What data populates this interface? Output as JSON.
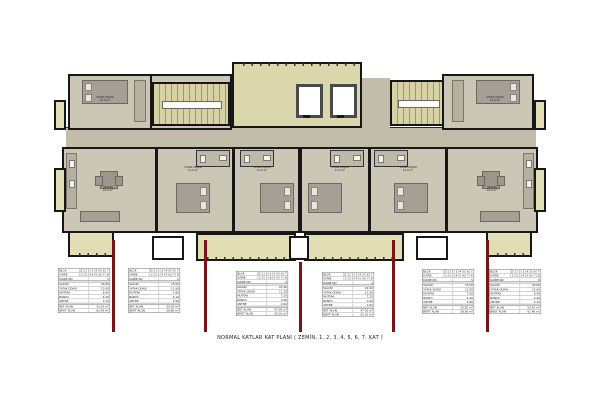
{
  "caption": "NORMAL KATLAR KAT PLANI ( ZEMİN, 1, 2, 3, 4, 5, 6, 7. KAT )",
  "colors": {
    "wall": "#171717",
    "floor": "#ccc6b7",
    "corridor": "#c2bcab",
    "terrace": "#dbd7ac",
    "balcony": "#e1ddb4",
    "stair": "#d6d2a6",
    "section_line": "#7a1517",
    "furniture": "#a5a095",
    "paper": "#ffffff"
  },
  "room_labels": [
    {
      "name": "YATAK ODASI",
      "area": "12.6 m²"
    },
    {
      "name": "SALON",
      "area": "24.8 m²"
    },
    {
      "name": "YATAK ODASI",
      "area": "11.9 m²"
    },
    {
      "name": "YATAK ODASI",
      "area": "11.2 m²"
    },
    {
      "name": "YATAK ODASI",
      "area": "11.2 m²"
    },
    {
      "name": "YATAK ODASI",
      "area": "11.9 m²"
    },
    {
      "name": "YATAK ODASI",
      "area": "12.6 m²"
    },
    {
      "name": "SALON",
      "area": "24.8 m²"
    }
  ],
  "tables": [
    {
      "block_label": "BLOK",
      "floors": [
        "Z",
        "1",
        "2",
        "3",
        "4",
        "5",
        "6",
        "7"
      ],
      "daire_label": "DAİRE",
      "daire_cells": [
        "1",
        "2",
        "3",
        "4",
        "5",
        "6",
        "7",
        "8"
      ],
      "daire_no_label": "DAİRE NO",
      "daire_no": "1",
      "rows": [
        {
          "label": "SALON",
          "value": "24.80"
        },
        {
          "label": "YATAK ODASI",
          "value": "12.60"
        },
        {
          "label": "MUTFAK",
          "value": "8.40"
        },
        {
          "label": "BANYO",
          "value": "4.20"
        },
        {
          "label": "ANTRE",
          "value": "3.10"
        }
      ],
      "totals": [
        {
          "label": "NET ALAN",
          "value": "53.10 m²"
        },
        {
          "label": "BRÜT ALAN",
          "value": "61.40 m²"
        }
      ]
    },
    {
      "block_label": "BLOK",
      "floors": [
        "Z",
        "1",
        "2",
        "3",
        "4",
        "5",
        "6",
        "7"
      ],
      "daire_label": "DAİRE",
      "daire_cells": [
        "1",
        "2",
        "3",
        "4",
        "5",
        "6",
        "7",
        "8"
      ],
      "daire_no_label": "DAİRE NO",
      "daire_no": "2",
      "rows": [
        {
          "label": "SALON",
          "value": "23.50"
        },
        {
          "label": "YATAK ODASI",
          "value": "11.90"
        },
        {
          "label": "MUTFAK",
          "value": "7.80"
        },
        {
          "label": "BANYO",
          "value": "4.10"
        },
        {
          "label": "ANTRE",
          "value": "2.90"
        }
      ],
      "totals": [
        {
          "label": "NET ALAN",
          "value": "50.20 m²"
        },
        {
          "label": "BRÜT ALAN",
          "value": "58.60 m²"
        }
      ]
    },
    {
      "block_label": "BLOK",
      "floors": [
        "Z",
        "1",
        "2",
        "3",
        "4",
        "5",
        "6",
        "7"
      ],
      "daire_label": "DAİRE",
      "daire_cells": [
        "1",
        "2",
        "3",
        "4",
        "5",
        "6",
        "7",
        "8"
      ],
      "daire_no_label": "DAİRE NO",
      "daire_no": "3",
      "rows": [
        {
          "label": "SALON",
          "value": "22.40"
        },
        {
          "label": "YATAK ODASI",
          "value": "11.20"
        },
        {
          "label": "MUTFAK",
          "value": "7.20"
        },
        {
          "label": "BANYO",
          "value": "3.90"
        },
        {
          "label": "ANTRE",
          "value": "2.60"
        }
      ],
      "totals": [
        {
          "label": "NET ALAN",
          "value": "47.30 m²"
        },
        {
          "label": "BRÜT ALAN",
          "value": "55.10 m²"
        }
      ]
    },
    {
      "block_label": "BLOK",
      "floors": [
        "Z",
        "1",
        "2",
        "3",
        "4",
        "5",
        "6",
        "7"
      ],
      "daire_label": "DAİRE",
      "daire_cells": [
        "1",
        "2",
        "3",
        "4",
        "5",
        "6",
        "7",
        "8"
      ],
      "daire_no_label": "DAİRE NO",
      "daire_no": "4",
      "rows": [
        {
          "label": "SALON",
          "value": "22.40"
        },
        {
          "label": "YATAK ODASI",
          "value": "11.20"
        },
        {
          "label": "MUTFAK",
          "value": "7.20"
        },
        {
          "label": "BANYO",
          "value": "3.90"
        },
        {
          "label": "ANTRE",
          "value": "2.60"
        }
      ],
      "totals": [
        {
          "label": "NET ALAN",
          "value": "47.30 m²"
        },
        {
          "label": "BRÜT ALAN",
          "value": "55.10 m²"
        }
      ]
    },
    {
      "block_label": "BLOK",
      "floors": [
        "Z",
        "1",
        "2",
        "3",
        "4",
        "5",
        "6",
        "7"
      ],
      "daire_label": "DAİRE",
      "daire_cells": [
        "1",
        "2",
        "3",
        "4",
        "5",
        "6",
        "7",
        "8"
      ],
      "daire_no_label": "DAİRE NO",
      "daire_no": "5",
      "rows": [
        {
          "label": "SALON",
          "value": "23.50"
        },
        {
          "label": "YATAK ODASI",
          "value": "11.90"
        },
        {
          "label": "MUTFAK",
          "value": "7.80"
        },
        {
          "label": "BANYO",
          "value": "4.10"
        },
        {
          "label": "ANTRE",
          "value": "2.90"
        }
      ],
      "totals": [
        {
          "label": "NET ALAN",
          "value": "50.20 m²"
        },
        {
          "label": "BRÜT ALAN",
          "value": "58.60 m²"
        }
      ]
    },
    {
      "block_label": "BLOK",
      "floors": [
        "Z",
        "1",
        "2",
        "3",
        "4",
        "5",
        "6",
        "7"
      ],
      "daire_label": "DAİRE",
      "daire_cells": [
        "1",
        "2",
        "3",
        "4",
        "5",
        "6",
        "7",
        "8"
      ],
      "daire_no_label": "DAİRE NO",
      "daire_no": "6",
      "rows": [
        {
          "label": "SALON",
          "value": "24.80"
        },
        {
          "label": "YATAK ODASI",
          "value": "12.60"
        },
        {
          "label": "MUTFAK",
          "value": "8.40"
        },
        {
          "label": "BANYO",
          "value": "4.20"
        },
        {
          "label": "ANTRE",
          "value": "3.10"
        }
      ],
      "totals": [
        {
          "label": "NET ALAN",
          "value": "53.10 m²"
        },
        {
          "label": "BRÜT ALAN",
          "value": "61.40 m²"
        }
      ]
    }
  ]
}
